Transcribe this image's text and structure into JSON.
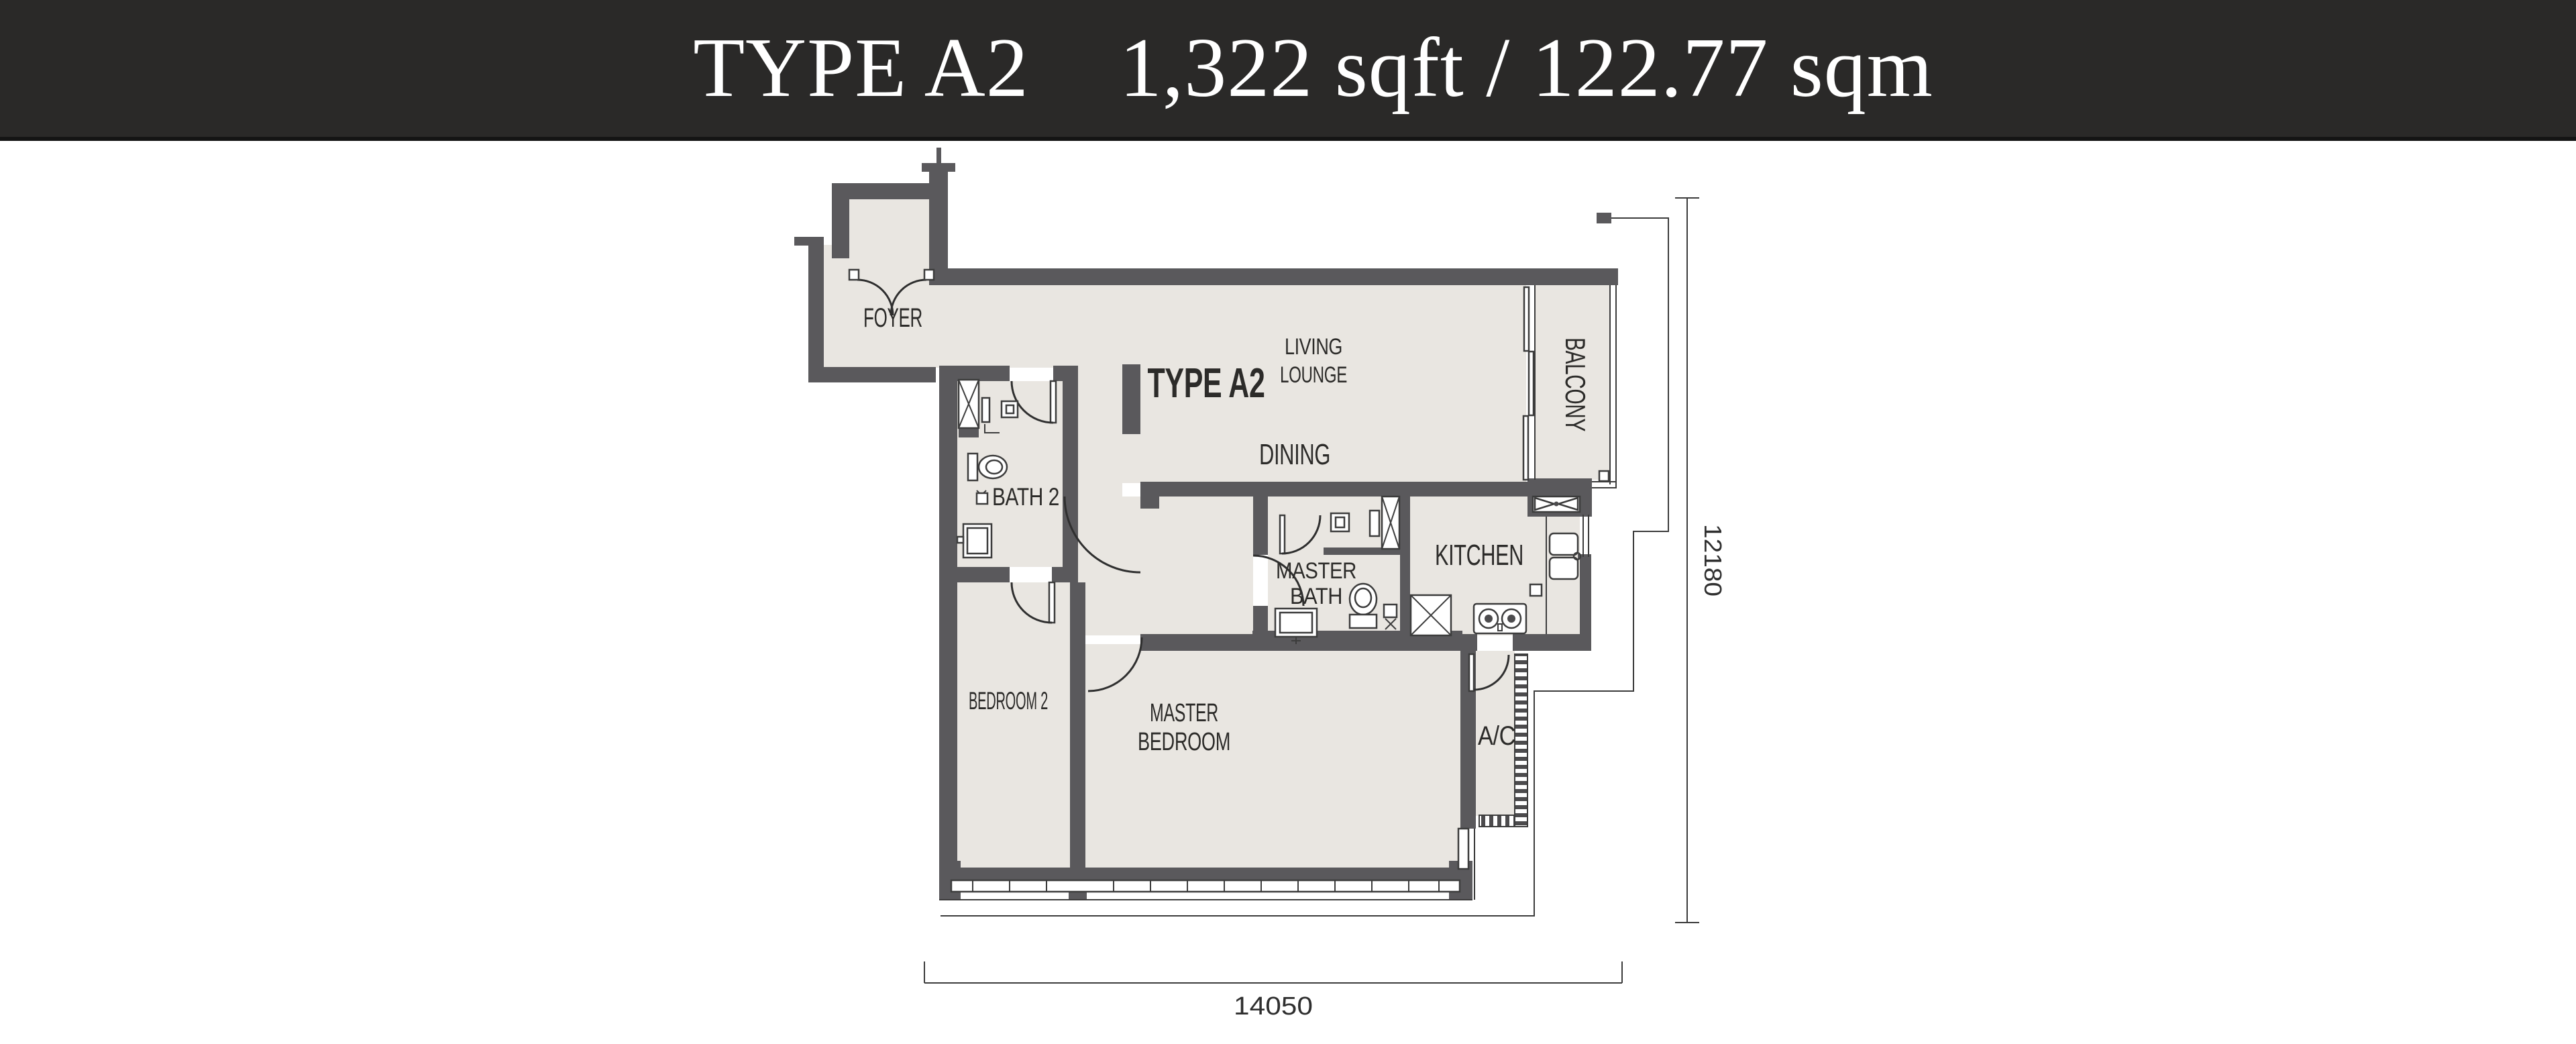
{
  "header": {
    "type_label": "TYPE A2",
    "area_label": "1,322 sqft / 122.77 sqm"
  },
  "plan": {
    "unit_label": "TYPE A2",
    "labels": {
      "foyer": "FOYER",
      "living_1": "LIVING",
      "living_2": "LOUNGE",
      "dining": "DINING",
      "balcony": "BALCONY",
      "bath2": "BATH 2",
      "master_bath_1": "MASTER",
      "master_bath_2": "BATH",
      "kitchen": "KITCHEN",
      "bedroom2": "BEDROOM 2",
      "master_bedroom_1": "MASTER",
      "master_bedroom_2": "BEDROOM",
      "ac": "A/C"
    },
    "dimensions": {
      "horizontal": "14050",
      "vertical": "12180"
    },
    "colors": {
      "wall": "#5a595c",
      "floor": "#e9e6e1",
      "line": "#3c3c3c",
      "label": "#2c2b29",
      "header_bg": "#2a2928",
      "header_text": "#ffffff"
    }
  }
}
